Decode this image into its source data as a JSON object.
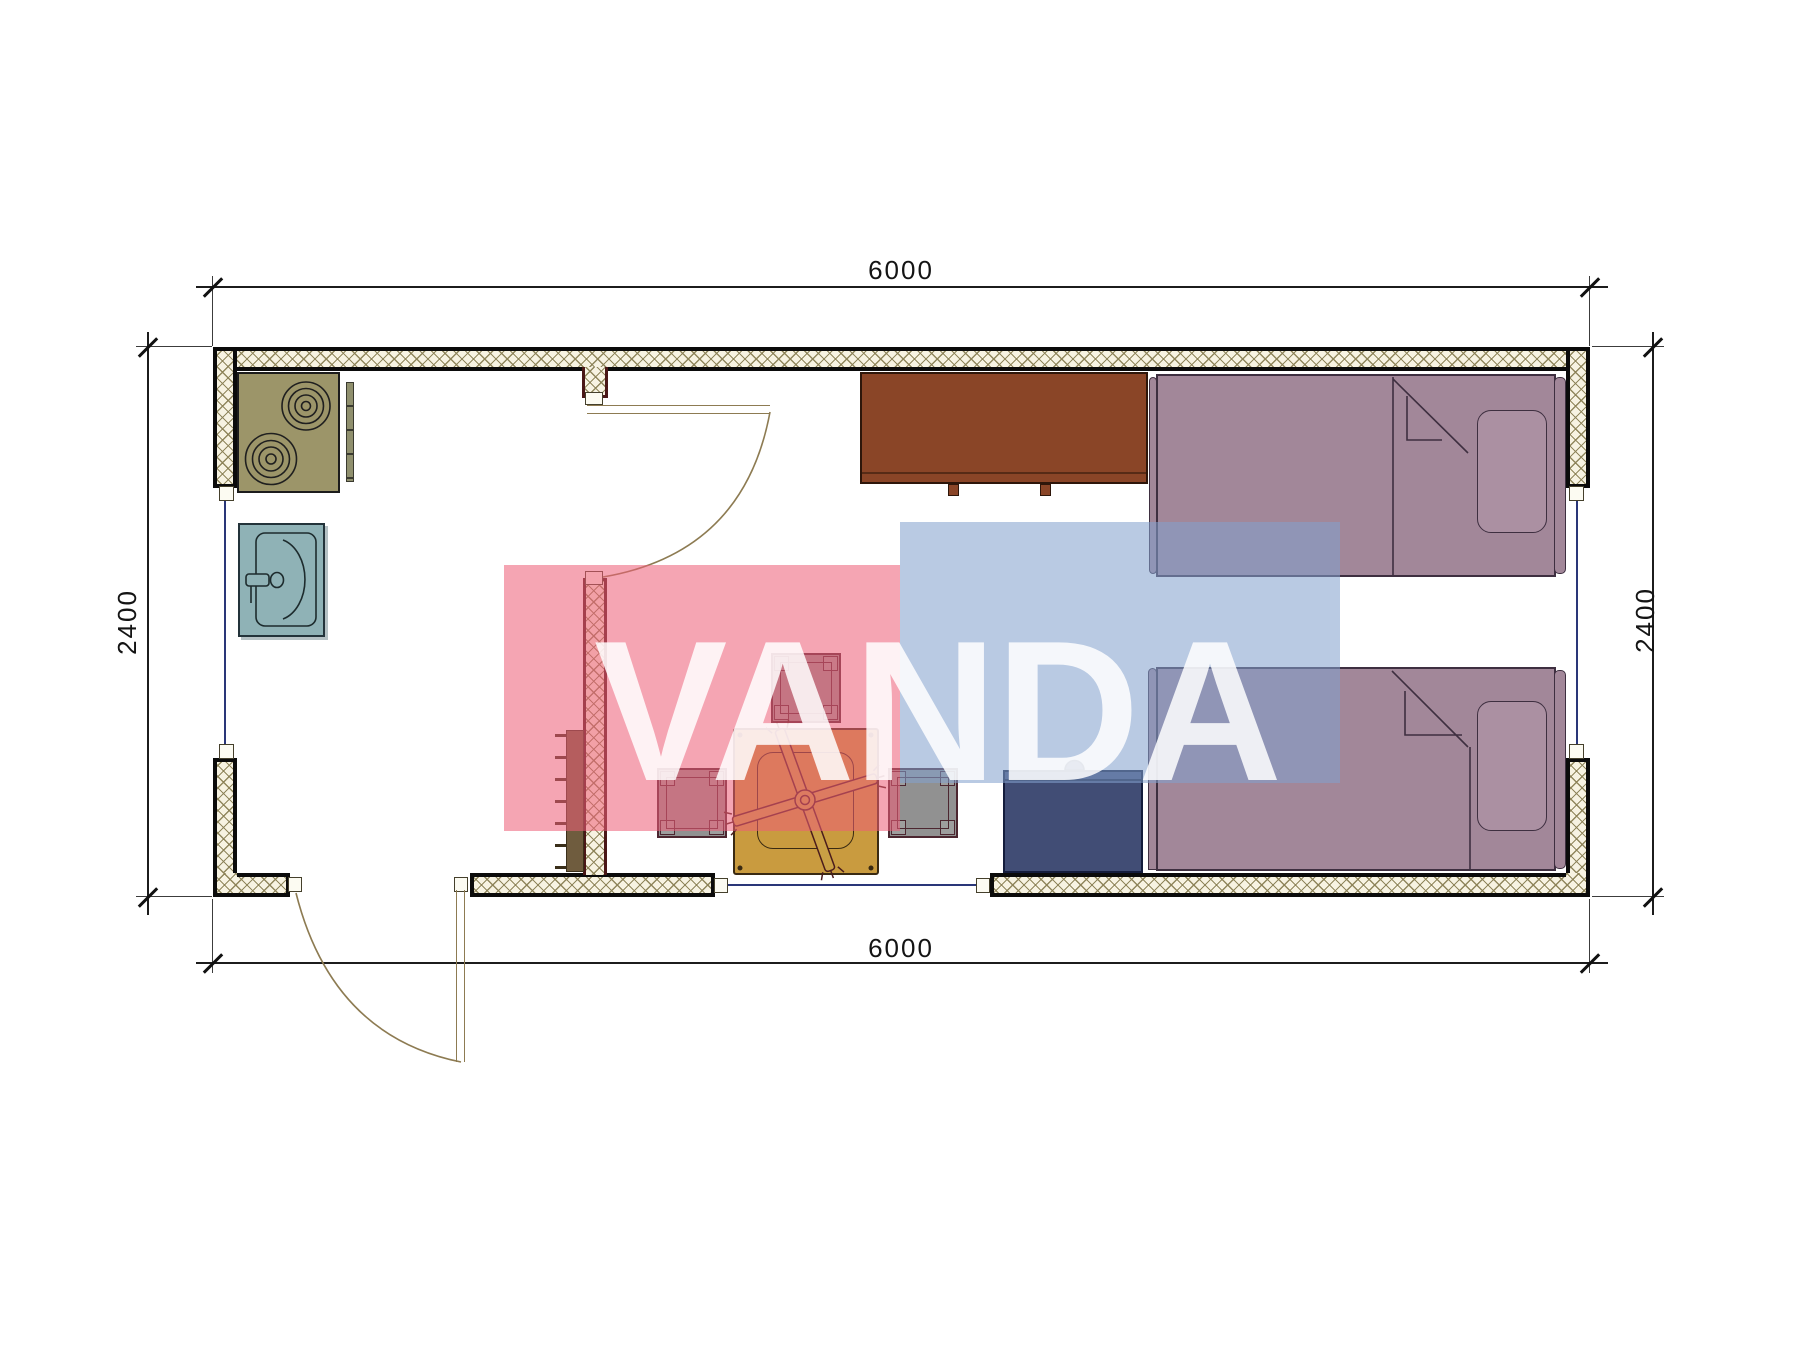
{
  "document": {
    "type": "architectural-floor-plan",
    "description": "Top-view floor plan of a 6000 x 2400 mm container house with kitchen, dining area and two single beds"
  },
  "dimensions": {
    "top_width_mm": "6000",
    "bottom_width_mm": "6000",
    "left_height_mm": "2400",
    "right_height_mm": "2400"
  },
  "watermark": {
    "text": "VANDA",
    "pink_color": "#ed5f78",
    "blue_color": "#82a0cd",
    "letter_color": "#ffffff"
  },
  "palette": {
    "wall_hatch_line": "#8b8156",
    "wall_hatch_bg": "#f7f3e2",
    "wall_edge": "#0b0b0b",
    "interior_wall_edge": "#4a1717",
    "stove": "#9c9569",
    "sink": "#8fb2b6",
    "kitchen_cabinet": "#8a4527",
    "bed": "#a28799",
    "table": "#c99b3f",
    "stool": "#919191",
    "chest": "#414d75",
    "radiator": "#6f5c3e",
    "door_arc": "#8d7b52",
    "window_glass": "#2a3678"
  },
  "furniture": [
    {
      "name": "stove",
      "room": "kitchen"
    },
    {
      "name": "sink",
      "room": "kitchen"
    },
    {
      "name": "kitchen-cabinet",
      "room": "bedroom"
    },
    {
      "name": "dining-table",
      "room": "living"
    },
    {
      "name": "stool",
      "count": 3
    },
    {
      "name": "chest",
      "room": "bedroom"
    },
    {
      "name": "bed",
      "count": 2
    },
    {
      "name": "radiator",
      "room": "living"
    }
  ],
  "openings": [
    {
      "name": "entrance-door",
      "wall": "bottom-left"
    },
    {
      "name": "interior-door",
      "wall": "partition"
    },
    {
      "name": "window",
      "wall": "left"
    },
    {
      "name": "window",
      "wall": "right"
    },
    {
      "name": "window",
      "wall": "bottom"
    }
  ]
}
